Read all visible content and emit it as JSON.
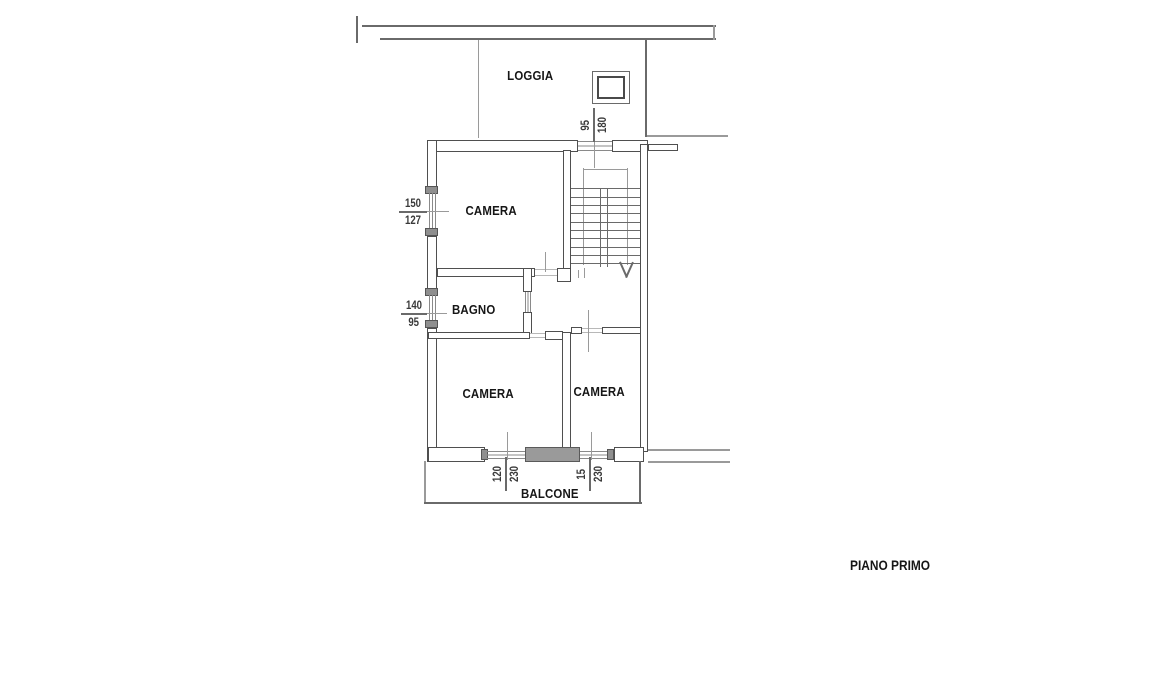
{
  "plan": {
    "title": "PIANO PRIMO",
    "rooms": {
      "loggia": "LOGGIA",
      "camera_top": "CAMERA",
      "bagno": "BAGNO",
      "camera_bottom_left": "CAMERA",
      "camera_bottom_right": "CAMERA",
      "balcone": "BALCONE"
    },
    "dimensions": {
      "camera_top_window": {
        "width": "150",
        "height": "127"
      },
      "bagno_window": {
        "width": "140",
        "height": "95"
      },
      "stair_window": {
        "width": "95",
        "height": "180"
      },
      "camera_bottom_left_window": {
        "width": "120",
        "height": "230"
      },
      "camera_bottom_right_door": {
        "width": "15",
        "height": "230"
      }
    },
    "colors": {
      "background": "#ffffff",
      "wall_line": "#4f4f4f",
      "thin_line": "#8a8a8a",
      "wall_fill": "#9a9a9a",
      "text": "#161616"
    }
  }
}
